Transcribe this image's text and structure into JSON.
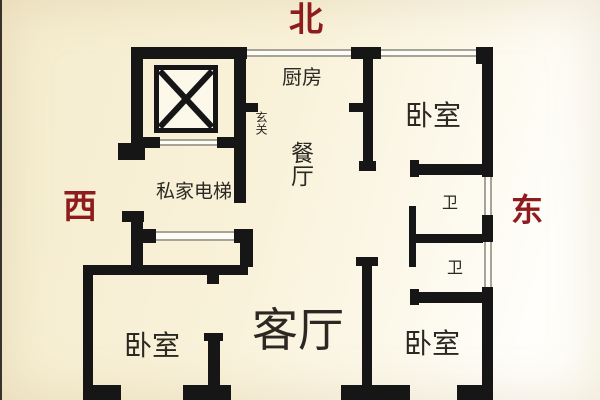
{
  "title": "apartment-floor-plan",
  "compass": {
    "north": "北",
    "west": "西",
    "east": "东"
  },
  "rooms": {
    "kitchen": "厨房",
    "entry": "玄关",
    "dining": "餐厅",
    "elevator_lobby": "私家电梯",
    "bedroom_northeast": "卧室",
    "bathroom_upper": "卫",
    "bathroom_lower": "卫",
    "living_room": "客厅",
    "bedroom_southwest": "卧室",
    "bedroom_southeast": "卧室"
  },
  "colors": {
    "compass_red": "#8e1c1c",
    "wall_black": "#161616",
    "window_gray": "#a8a396",
    "label_dark": "#2b2823",
    "bg_cream": "#f5ecce",
    "bg_white": "#fffff9"
  }
}
